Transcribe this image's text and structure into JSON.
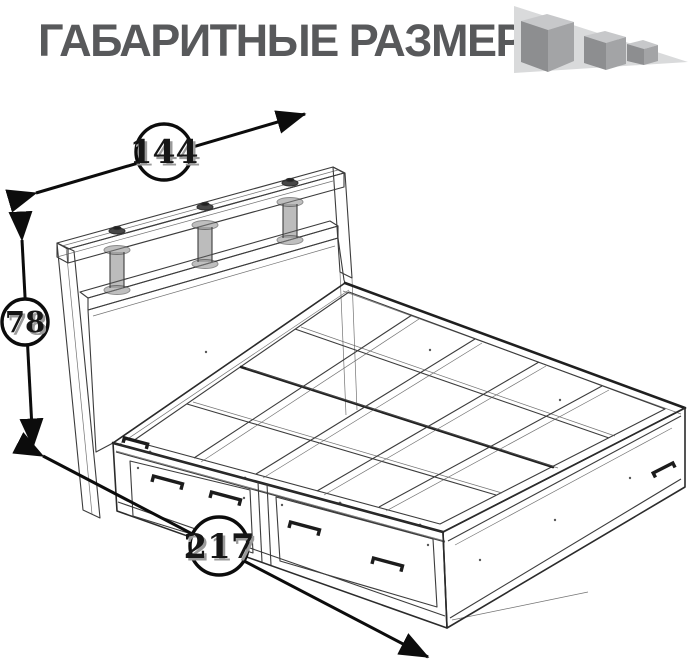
{
  "title": "ГАБАРИТНЫЕ РАЗМЕРЫ",
  "dimensions": {
    "width_cm": {
      "value": "144",
      "orientation": "diagonal-top"
    },
    "height_cm": {
      "value": "78",
      "orientation": "vertical-left"
    },
    "length_cm": {
      "value": "217",
      "orientation": "diagonal-bottom"
    }
  },
  "logo": {
    "name": "three-cubes-logo",
    "triangle_color": "#d9dadb",
    "cube_top_color": "#c7c8ca",
    "cube_left_color": "#8d8e90",
    "cube_right_color": "#a3a4a6"
  },
  "colors": {
    "title_text": "#58595b",
    "drawing_line": "#3c3c3c",
    "dimension_line": "#0c0c0c",
    "background": "#ffffff"
  },
  "drawing": {
    "subject": "bed with headboard shelf and two storage drawers, wireframe perspective view",
    "callout_values": [
      "144",
      "78",
      "217"
    ]
  }
}
